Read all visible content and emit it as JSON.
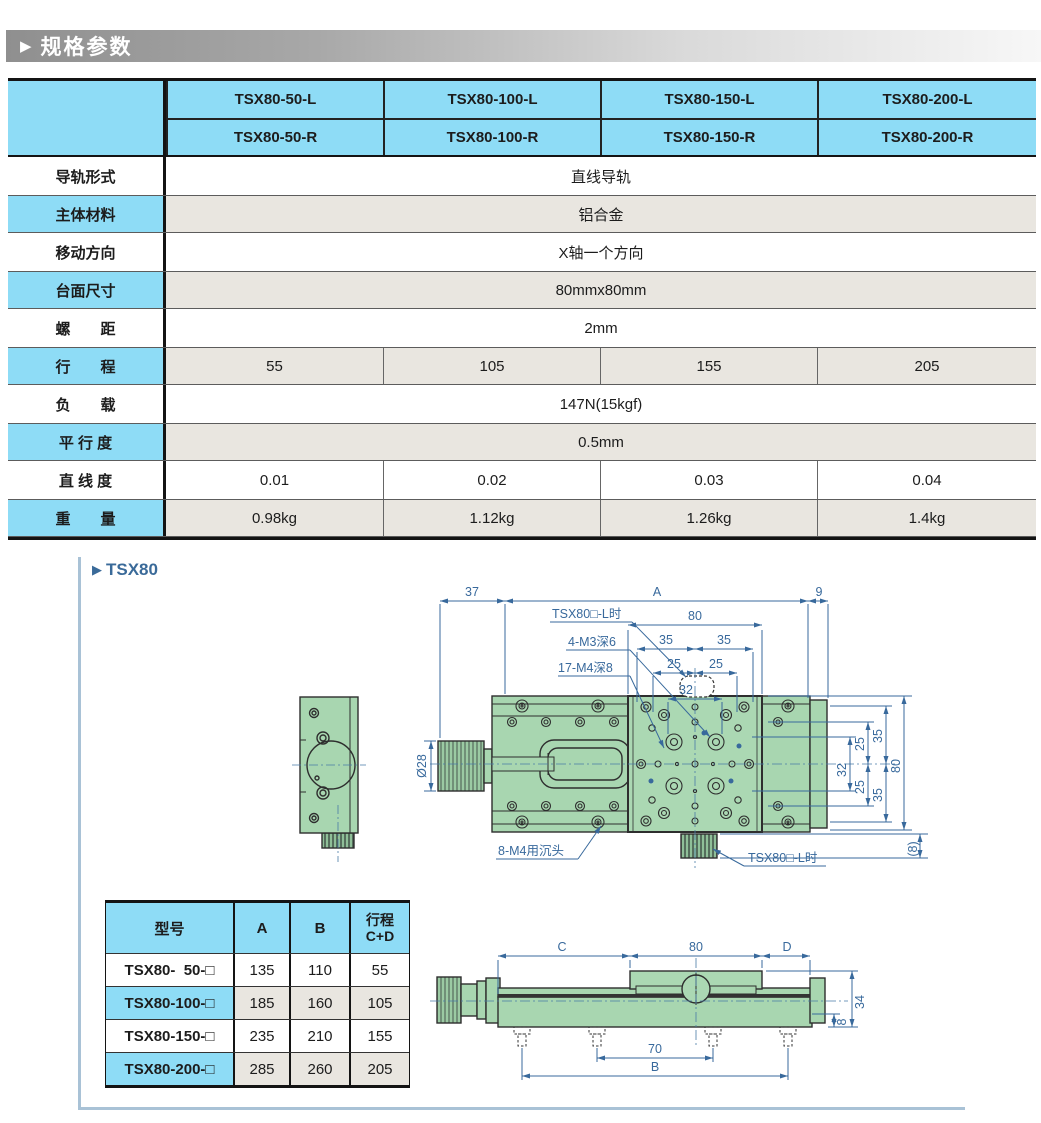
{
  "banner": {
    "title": "规格参数"
  },
  "section": {
    "title": "TSX80"
  },
  "colors": {
    "header_blue": "#8edcf6",
    "row_beige": "#e9e6e0",
    "drawing_green": "#a8d6b0",
    "dimension_blue": "#38699c",
    "banner_gray": "#8f8f8f",
    "panel_border": "#a9c2d6"
  },
  "spec_table": {
    "models_l": [
      "TSX80-50-L",
      "TSX80-100-L",
      "TSX80-150-L",
      "TSX80-200-L"
    ],
    "models_r": [
      "TSX80-50-R",
      "TSX80-100-R",
      "TSX80-150-R",
      "TSX80-200-R"
    ],
    "rows": [
      {
        "label": "导轨形式",
        "value": "直线导轨"
      },
      {
        "label": "主体材料",
        "value": "铝合金"
      },
      {
        "label": "移动方向",
        "value": "X轴一个方向"
      },
      {
        "label": "台面尺寸",
        "value": "80mmx80mm"
      },
      {
        "label": "螺　　距",
        "value": "2mm"
      },
      {
        "label": "行　　程",
        "values": [
          "55",
          "105",
          "155",
          "205"
        ]
      },
      {
        "label": "负　　载",
        "value": "147N(15kgf)"
      },
      {
        "label": "平 行 度",
        "value": "0.5mm"
      },
      {
        "label": "直 线 度",
        "values": [
          "0.01",
          "0.02",
          "0.03",
          "0.04"
        ]
      },
      {
        "label": "重　　量",
        "values": [
          "0.98kg",
          "1.12kg",
          "1.26kg",
          "1.4kg"
        ]
      }
    ]
  },
  "model_table": {
    "headers": [
      "型号",
      "A",
      "B",
      "行程\nC+D"
    ],
    "rows": [
      {
        "model": "TSX80-  50-□",
        "a": "135",
        "b": "110",
        "stroke": "55"
      },
      {
        "model": "TSX80-100-□",
        "a": "185",
        "b": "160",
        "stroke": "105"
      },
      {
        "model": "TSX80-150-□",
        "a": "235",
        "b": "210",
        "stroke": "155"
      },
      {
        "model": "TSX80-200-□",
        "a": "285",
        "b": "260",
        "stroke": "205"
      }
    ]
  },
  "top_view": {
    "dim_37": "37",
    "dim_A": "A",
    "dim_9": "9",
    "dim_80": "80",
    "dim_35": "35",
    "dim_25": "25",
    "dim_32": "32",
    "label_variant_top": "TSX80□-L时",
    "label_m3": "4-M3深6",
    "label_m4": "17-M4深8",
    "label_sink": "8-M4用沉头",
    "label_variant_bottom": "TSX80□-L时",
    "dia_knob": "Ø28",
    "right_35": "35",
    "right_25": "25",
    "right_32": "32",
    "right_80": "80",
    "dim_8paren": "(8)"
  },
  "side_view": {
    "dim_C": "C",
    "dim_80": "80",
    "dim_D": "D",
    "dim_34": "34",
    "dim_8": "8",
    "dim_70": "70",
    "dim_B": "B"
  }
}
